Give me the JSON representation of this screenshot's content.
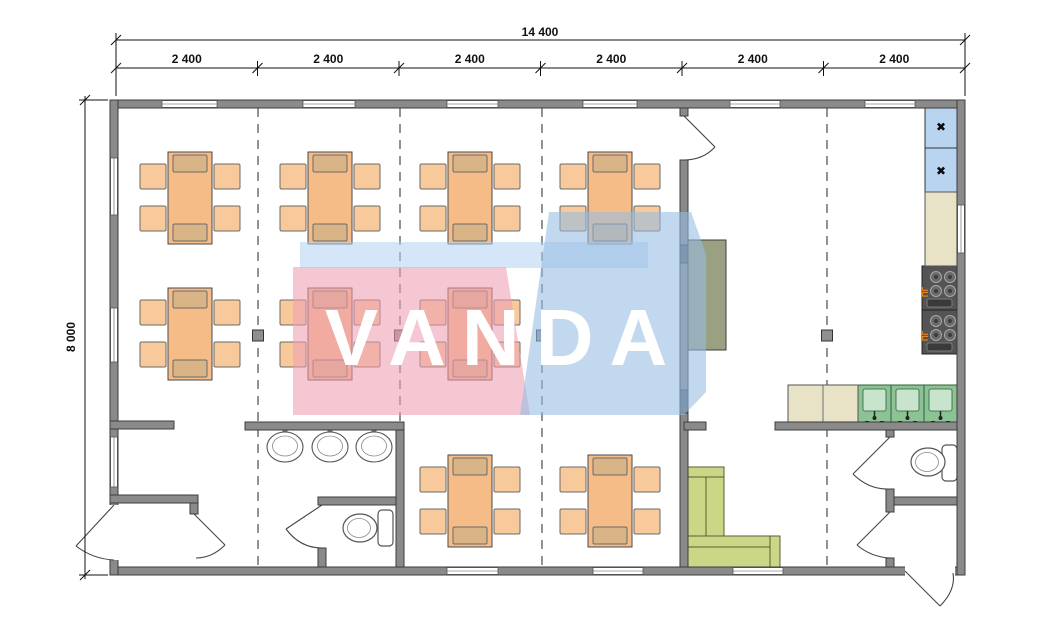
{
  "watermark": {
    "text": "VANDA",
    "pink_color": "#ee9fb4",
    "blue_color": "#96bce2",
    "band_color": "#b0d2f0"
  },
  "dimensions": {
    "total_width": "14 400",
    "height": "8 000",
    "modules": [
      "2 400",
      "2 400",
      "2 400",
      "2 400",
      "2 400",
      "2 400"
    ]
  },
  "plan": {
    "stove_label": "ПГ",
    "refrigerator_glyph": "✖",
    "counts": {
      "dining_tables": 9,
      "seats_per_table": 6,
      "washbasins": 3,
      "kitchen_sinks": 3,
      "toilets": 2,
      "refrigerators": 2,
      "stoves": 2,
      "sofas": 1
    },
    "colors": {
      "wall": "#8a8a8a",
      "table": "#f5bc88",
      "chair": "#f8ca9b",
      "chair_tucked": "#d9b486",
      "sofa": "#ccd687",
      "counter": "#e8e2c6",
      "sink": "#8cc394",
      "sink_inner": "#c8e4cc",
      "refrigerator": "#b9d4f1",
      "stove": "#545454",
      "serving_counter": "#9aa183",
      "stove_label_color": "#e8821e"
    }
  }
}
